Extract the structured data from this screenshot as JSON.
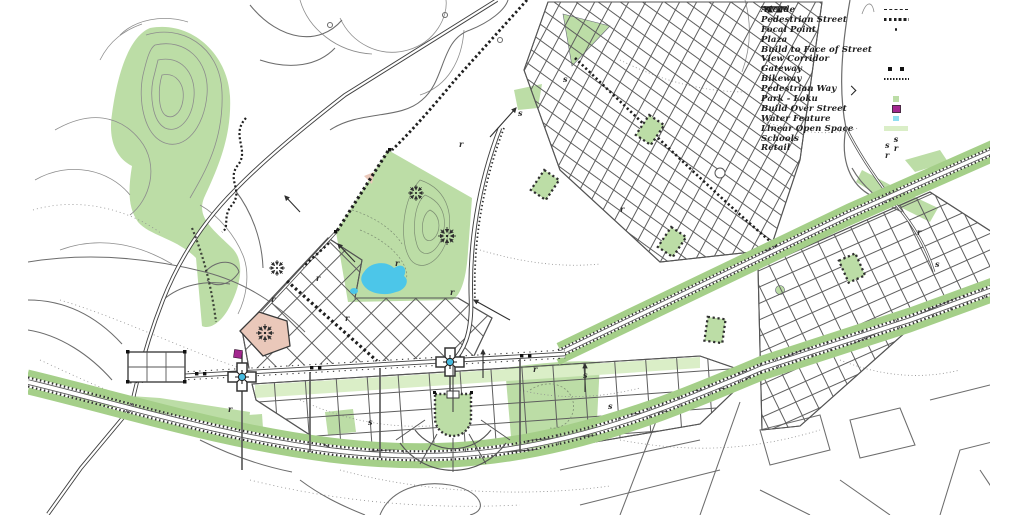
{
  "legend": {
    "items": [
      {
        "label": "Arcade",
        "symbol": "dashed-line"
      },
      {
        "label": "Pedestrian Street",
        "symbol": "dotted-squares"
      },
      {
        "label": "Focal Point",
        "symbol": "point-dot"
      },
      {
        "label": "Plaza",
        "symbol": "none"
      },
      {
        "label": "Build to Face of Street",
        "symbol": "line-with-triangles"
      },
      {
        "label": "View Corridor",
        "symbol": "left-arrow"
      },
      {
        "label": "Gateway",
        "symbol": "two-squares"
      },
      {
        "label": "Bikeway",
        "symbol": "fine-dotted-line"
      },
      {
        "label": "Pedestrian Way",
        "symbol": "chevron"
      },
      {
        "label": "Park - Loku",
        "symbol": "green-square"
      },
      {
        "label": "Build Over Street",
        "symbol": "magenta-square"
      },
      {
        "label": "Water Feature",
        "symbol": "cyan-square"
      },
      {
        "label": "Linear Open Space",
        "symbol": "light-green-bar"
      },
      {
        "label": "Schools",
        "symbol_text": "s"
      },
      {
        "label": "Retail",
        "symbol_text": "r"
      }
    ]
  },
  "map": {
    "labels": [
      {
        "t": "r"
      },
      {
        "t": "r"
      },
      {
        "t": "r"
      },
      {
        "t": "r"
      },
      {
        "t": "r"
      },
      {
        "t": "r"
      },
      {
        "t": "r"
      },
      {
        "t": "r"
      },
      {
        "t": "r"
      },
      {
        "t": "r"
      },
      {
        "t": "r"
      },
      {
        "t": "s"
      },
      {
        "t": "s"
      },
      {
        "t": "s"
      },
      {
        "t": "s"
      },
      {
        "t": "s"
      },
      {
        "t": "s"
      },
      {
        "t": "s"
      }
    ]
  },
  "colors": {
    "park": "#bcdda6",
    "open": "#daeec7",
    "strip": "#a5cf89",
    "water": "#4cc6e9",
    "waterL": "#8fdef0",
    "pink": "#eac8ba",
    "magenta": "#a3278f",
    "focal": "#45b9de",
    "ink": "#2e2e2e"
  }
}
